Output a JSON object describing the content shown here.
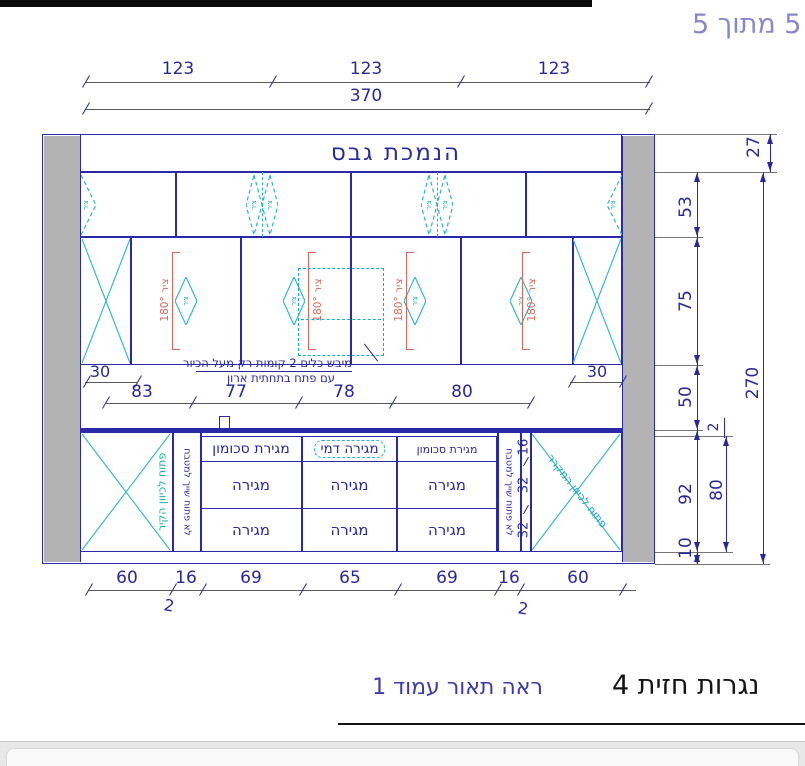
{
  "page": {
    "page_label": "5 מתוך 5"
  },
  "labels": {
    "ceiling": "הנמכת גבס",
    "hinge": "ציר",
    "hinge180": "ציר 180°",
    "callout_line1": "מיבש כלים 2 קומות רק מעל הכיור",
    "callout_line2": "עם פתח בתחתית ארון",
    "left_corner_note": "פתוח לכיוון הקיר",
    "right_corner_note": "פתוח לכיוון המקרר",
    "filler_note": "לא פתוח שייך למטבח",
    "drawer": "מגירה",
    "drawer_cutlery": "מגירת סכומון",
    "drawer_dummy": "מגירה דמי"
  },
  "dims": {
    "top_segments": [
      "123",
      "123",
      "123"
    ],
    "top_total": "370",
    "mid_left": "30",
    "mid_right": "30",
    "mid_chain": [
      "83",
      "77",
      "78",
      "80"
    ],
    "bottom_chain": [
      "60",
      "16",
      "69",
      "65",
      "69",
      "16",
      "60"
    ],
    "filler_mark": "2",
    "right_27": "27",
    "right_53": "53",
    "right_75": "75",
    "right_270": "270",
    "right_50": "50",
    "right_2": "2",
    "right_92": "92",
    "right_80": "80",
    "right_10": "10",
    "drawer_heights": [
      "16",
      "32",
      "32"
    ]
  },
  "footer": {
    "see_note": "ראה תאור עמוד 1",
    "title": "נגרות חזית 4"
  }
}
